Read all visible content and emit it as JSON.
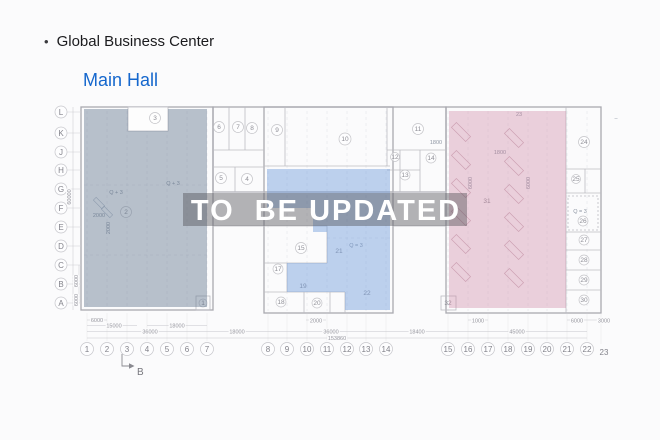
{
  "header": {
    "bullet": "•",
    "title": "Global Business Center",
    "hall": "Main Hall"
  },
  "watermark": {
    "text": "TO  BE UPDATED"
  },
  "axes": {
    "rows": [
      "L",
      "K",
      "J",
      "H",
      "G",
      "F",
      "E",
      "D",
      "C",
      "B",
      "A"
    ],
    "cols": [
      "1",
      "2",
      "3",
      "4",
      "5",
      "6",
      "7",
      "8",
      "9",
      "10",
      "11",
      "12",
      "13",
      "14",
      "15",
      "16",
      "17",
      "18",
      "19",
      "20",
      "21",
      "22"
    ],
    "col_extra": "23"
  },
  "rooms": {
    "r1": "1",
    "r2": "2",
    "r3": "3",
    "r4": "4",
    "r5": "5",
    "r6": "6",
    "r7": "7",
    "r8": "8",
    "r9": "9",
    "r10": "10",
    "r11": "11",
    "r12": "12",
    "r13": "13",
    "r14": "14",
    "r15": "15",
    "r17": "17",
    "r18": "18",
    "r19": "19",
    "r20": "20",
    "r21": "21",
    "r22": "22",
    "r24": "24",
    "r25": "25",
    "r26": "26",
    "r27": "27",
    "r28": "28",
    "r29": "29",
    "r30": "30",
    "r31": "31",
    "r32": "32"
  },
  "dims": {
    "d6000": "6000",
    "d15000": "15000",
    "d18000": "18000",
    "d36000": "36000",
    "d2000": "2000",
    "d153860": "153860",
    "d18400": "18400",
    "d45000": "45000",
    "d1000": "1000",
    "d3000": "3000",
    "d60000": "60000",
    "d1800": "1800"
  },
  "annotations": {
    "q_eq_3": "Q = 3",
    "q_plus_3": "Q + 3",
    "top_right_label": "23",
    "dash": "–",
    "section_marker": "B"
  },
  "colors": {
    "hall_title": "#1567cd",
    "zone_left": "rgba(100,120,145,0.45)",
    "zone_middle": "rgba(110,155,220,0.45)",
    "zone_right": "rgba(205,130,160,0.36)"
  }
}
